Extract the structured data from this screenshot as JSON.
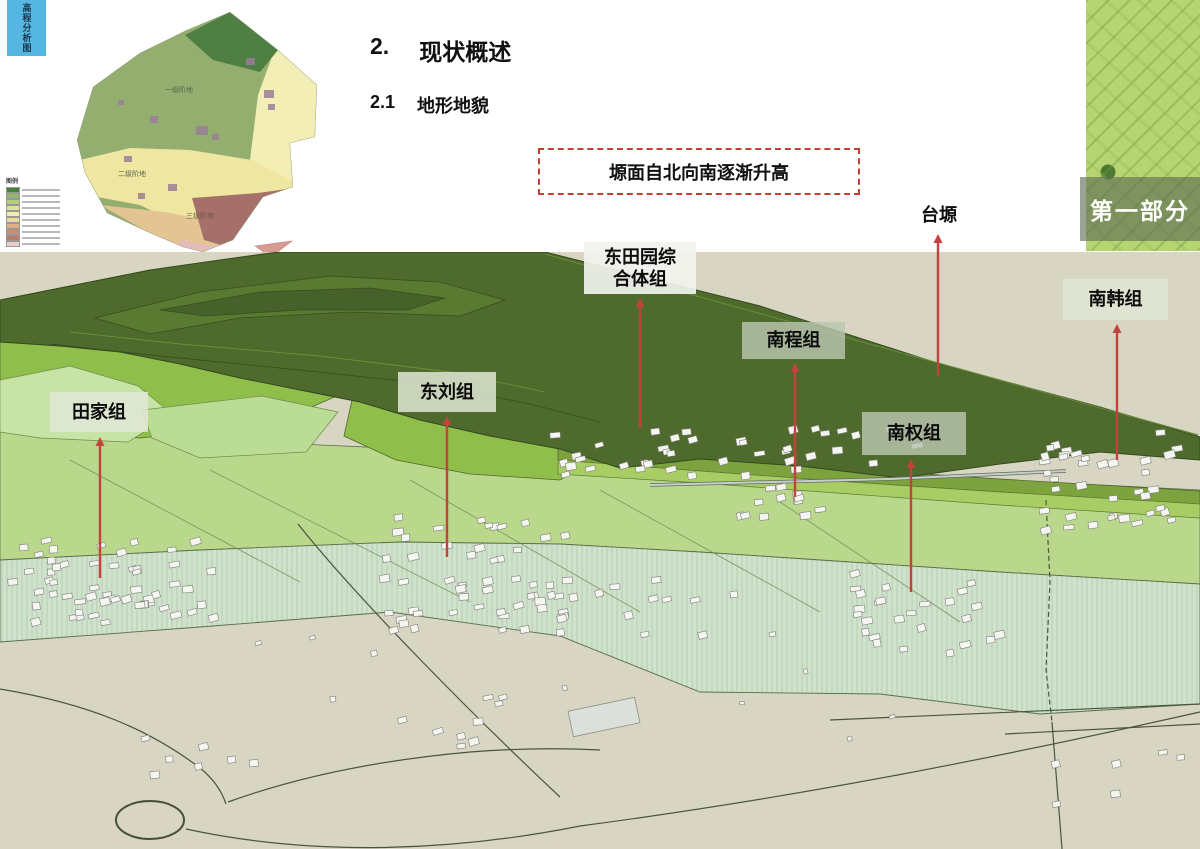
{
  "side_tab": {
    "label": "高程分析图",
    "bg": "#55b6e2"
  },
  "headings": {
    "section_number": "2.",
    "section_title": "现状概述",
    "subsection_number": "2.1",
    "subsection_title": "地形地貌"
  },
  "callout": {
    "text": "塬面自北向南逐渐升高",
    "border_color": "#c13f33"
  },
  "part_badge": {
    "label": "第一部分"
  },
  "small_map": {
    "legend_title": "图例",
    "area_labels": [
      "一级阶地",
      "二级阶地",
      "三级阶地"
    ],
    "legend_colors": [
      "#4e7d3f",
      "#8fb968",
      "#b5cc7a",
      "#dfe39a",
      "#f1ecb2",
      "#ecd9a2",
      "#ddb183",
      "#cb8e72",
      "#b97b6d",
      "#e9cdc9"
    ]
  },
  "terrain": {
    "colors": {
      "plateau": "#4e6a2d",
      "slope_green": "#8fbe4b",
      "plain": "#b9d88b",
      "terrace_pale": "#cfe2cb",
      "ground": "#d8d5c2",
      "arrow": "#c2423d"
    },
    "markers": [
      {
        "id": "tianjia",
        "lines": [
          "田家组"
        ],
        "boxed": true,
        "tone": "light",
        "box": [
          50,
          392,
          98,
          40
        ],
        "arrow_x": 100,
        "arrow_top": 437,
        "arrow_bottom": 578
      },
      {
        "id": "dongliu",
        "lines": [
          "东刘组"
        ],
        "boxed": true,
        "tone": "light",
        "box": [
          398,
          372,
          98,
          40
        ],
        "arrow_x": 447,
        "arrow_top": 416,
        "arrow_bottom": 557
      },
      {
        "id": "dongtianyuan",
        "lines": [
          "东田园综",
          "合体组"
        ],
        "boxed": true,
        "tone": "white",
        "box": [
          584,
          242,
          112,
          52
        ],
        "arrow_x": 640,
        "arrow_top": 298,
        "arrow_bottom": 428
      },
      {
        "id": "nancheng",
        "lines": [
          "南程组"
        ],
        "boxed": true,
        "tone": "dark",
        "box": [
          742,
          322,
          103,
          37
        ],
        "arrow_x": 795,
        "arrow_top": 363,
        "arrow_bottom": 497
      },
      {
        "id": "taiyuan",
        "lines": [
          "台塬"
        ],
        "boxed": false,
        "tone": "none",
        "box": [
          908,
          200,
          62,
          30
        ],
        "arrow_x": 938,
        "arrow_top": 234,
        "arrow_bottom": 376
      },
      {
        "id": "nanquan",
        "lines": [
          "南权组"
        ],
        "boxed": true,
        "tone": "dark",
        "box": [
          862,
          412,
          104,
          43
        ],
        "arrow_x": 911,
        "arrow_top": 459,
        "arrow_bottom": 592
      },
      {
        "id": "nanhan",
        "lines": [
          "南韩组"
        ],
        "boxed": true,
        "tone": "light",
        "box": [
          1063,
          279,
          105,
          41
        ],
        "arrow_x": 1117,
        "arrow_top": 324,
        "arrow_bottom": 460
      }
    ],
    "village_clusters": [
      {
        "id": "tianjia-village",
        "x": 18,
        "y": 537,
        "w": 195,
        "h": 85,
        "count": 42
      },
      {
        "id": "tianjia-west-row",
        "x": 0,
        "y": 560,
        "w": 150,
        "h": 60,
        "count": 14
      },
      {
        "id": "dongliu-village",
        "x": 378,
        "y": 512,
        "w": 185,
        "h": 118,
        "count": 52
      },
      {
        "id": "dongliu-east-tail",
        "x": 545,
        "y": 575,
        "w": 185,
        "h": 58,
        "count": 14
      },
      {
        "id": "dongtianyuan-village",
        "x": 548,
        "y": 424,
        "w": 390,
        "h": 50,
        "count": 40
      },
      {
        "id": "nancheng-village",
        "x": 735,
        "y": 476,
        "w": 96,
        "h": 44,
        "count": 13
      },
      {
        "id": "nanhan-village",
        "x": 1038,
        "y": 430,
        "w": 150,
        "h": 100,
        "count": 38
      },
      {
        "id": "nanquan-village",
        "x": 845,
        "y": 572,
        "w": 150,
        "h": 80,
        "count": 26
      },
      {
        "id": "roundabout-buildings",
        "x": 115,
        "y": 735,
        "w": 150,
        "h": 58,
        "count": 7
      },
      {
        "id": "center-buildings",
        "x": 385,
        "y": 695,
        "w": 115,
        "h": 52,
        "count": 9
      },
      {
        "id": "southeast-buildings",
        "x": 1040,
        "y": 745,
        "w": 160,
        "h": 58,
        "count": 6
      },
      {
        "id": "scattered-sheds",
        "x": 250,
        "y": 628,
        "w": 700,
        "h": 115,
        "count": 10,
        "small": true
      }
    ]
  }
}
